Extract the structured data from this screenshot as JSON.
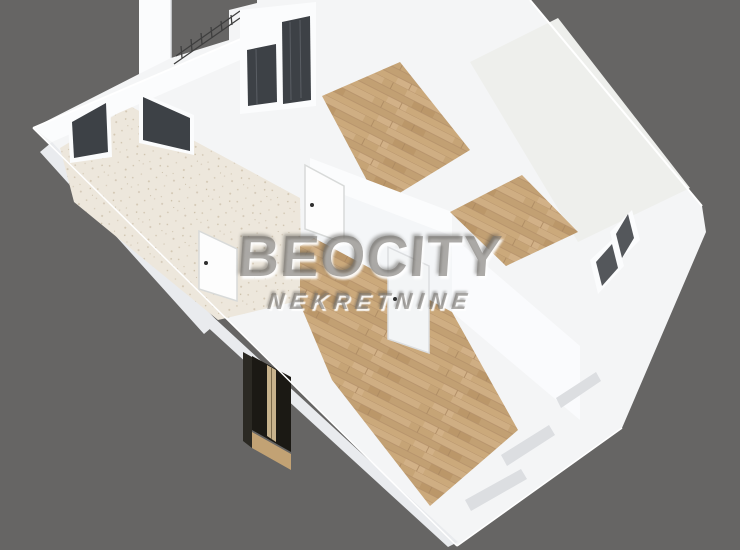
{
  "watermark": {
    "brand": "BEOCITY",
    "subtitle": "NEKRETNINE"
  },
  "scene": {
    "background": "#666564",
    "colors": {
      "wall": "#f4f5f6",
      "wall_bright": "#fbfcfd",
      "wall_shade": "#e9ebee",
      "wall_face": "#f4f6f8",
      "wall_face_light": "#fafbfd",
      "floor_pale": "#eeefec",
      "opening": "#3d4146",
      "glass": "#3d4146",
      "railing": "#3f3f3f",
      "entrance_door": "#1b1914",
      "entrance_recess": "#2b2923",
      "door_stripe": "#c7b28c",
      "threshold": "#c2a274",
      "door_white": "#fdfdfd",
      "door_white_dim": "#f3f5f6",
      "slit_dark": "#54575b",
      "slit_light": "#dcdee1",
      "handle": "#2f2f2f"
    },
    "rooms": [
      {
        "id": "bathroom",
        "floor": "speckled-tile"
      },
      {
        "id": "hallway",
        "floor": "wood"
      },
      {
        "id": "bedroom-top",
        "floor": "wood"
      },
      {
        "id": "room-right",
        "floor": "wood"
      },
      {
        "id": "room-top-right",
        "floor": "pale"
      },
      {
        "id": "living-room",
        "floor": "wood"
      }
    ],
    "elements": [
      "entrance-door",
      "balcony-door",
      "interior-door-1",
      "interior-door-2",
      "interior-door-3",
      "window-left",
      "window-bathroom",
      "balcony-railing",
      "window-slits-right",
      "window-slits-bottom"
    ]
  }
}
